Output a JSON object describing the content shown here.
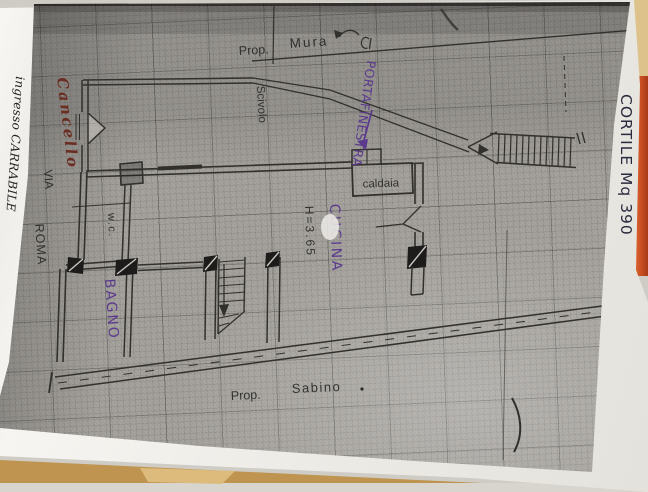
{
  "plan_labels": {
    "prop_top": {
      "word1": "Prop.",
      "word2": "Mura"
    },
    "scivolo": "Scivolo",
    "cancello": "Cancello",
    "via": "VIA",
    "roma": "ROMA",
    "ingresso_carrabile": "ingresso CARRABILE",
    "cortile": "CORTILE Mq 390",
    "portafinestra": "PORTAFINESTRA",
    "caldaia": "caldaia",
    "cucina": "CUCINA",
    "room_height": "H=3.65",
    "wc": "w.c.",
    "bagno": "BAGNO",
    "prop_bottom": {
      "word1": "Prop.",
      "word2": "Sabino"
    }
  },
  "ink_colors": {
    "plan_line": "#32302c",
    "typed_text": "#2b2a27",
    "purple_pen": "#5b3a8e",
    "red_pen": "#6b2d22",
    "blue_pen": "#2a2a3e"
  },
  "photo_colors": {
    "paper": "#f3f2ee",
    "plan_gray": "#a6a39e",
    "backdrop_orange": "#cf5226",
    "backdrop_tan": "#c9a263"
  }
}
